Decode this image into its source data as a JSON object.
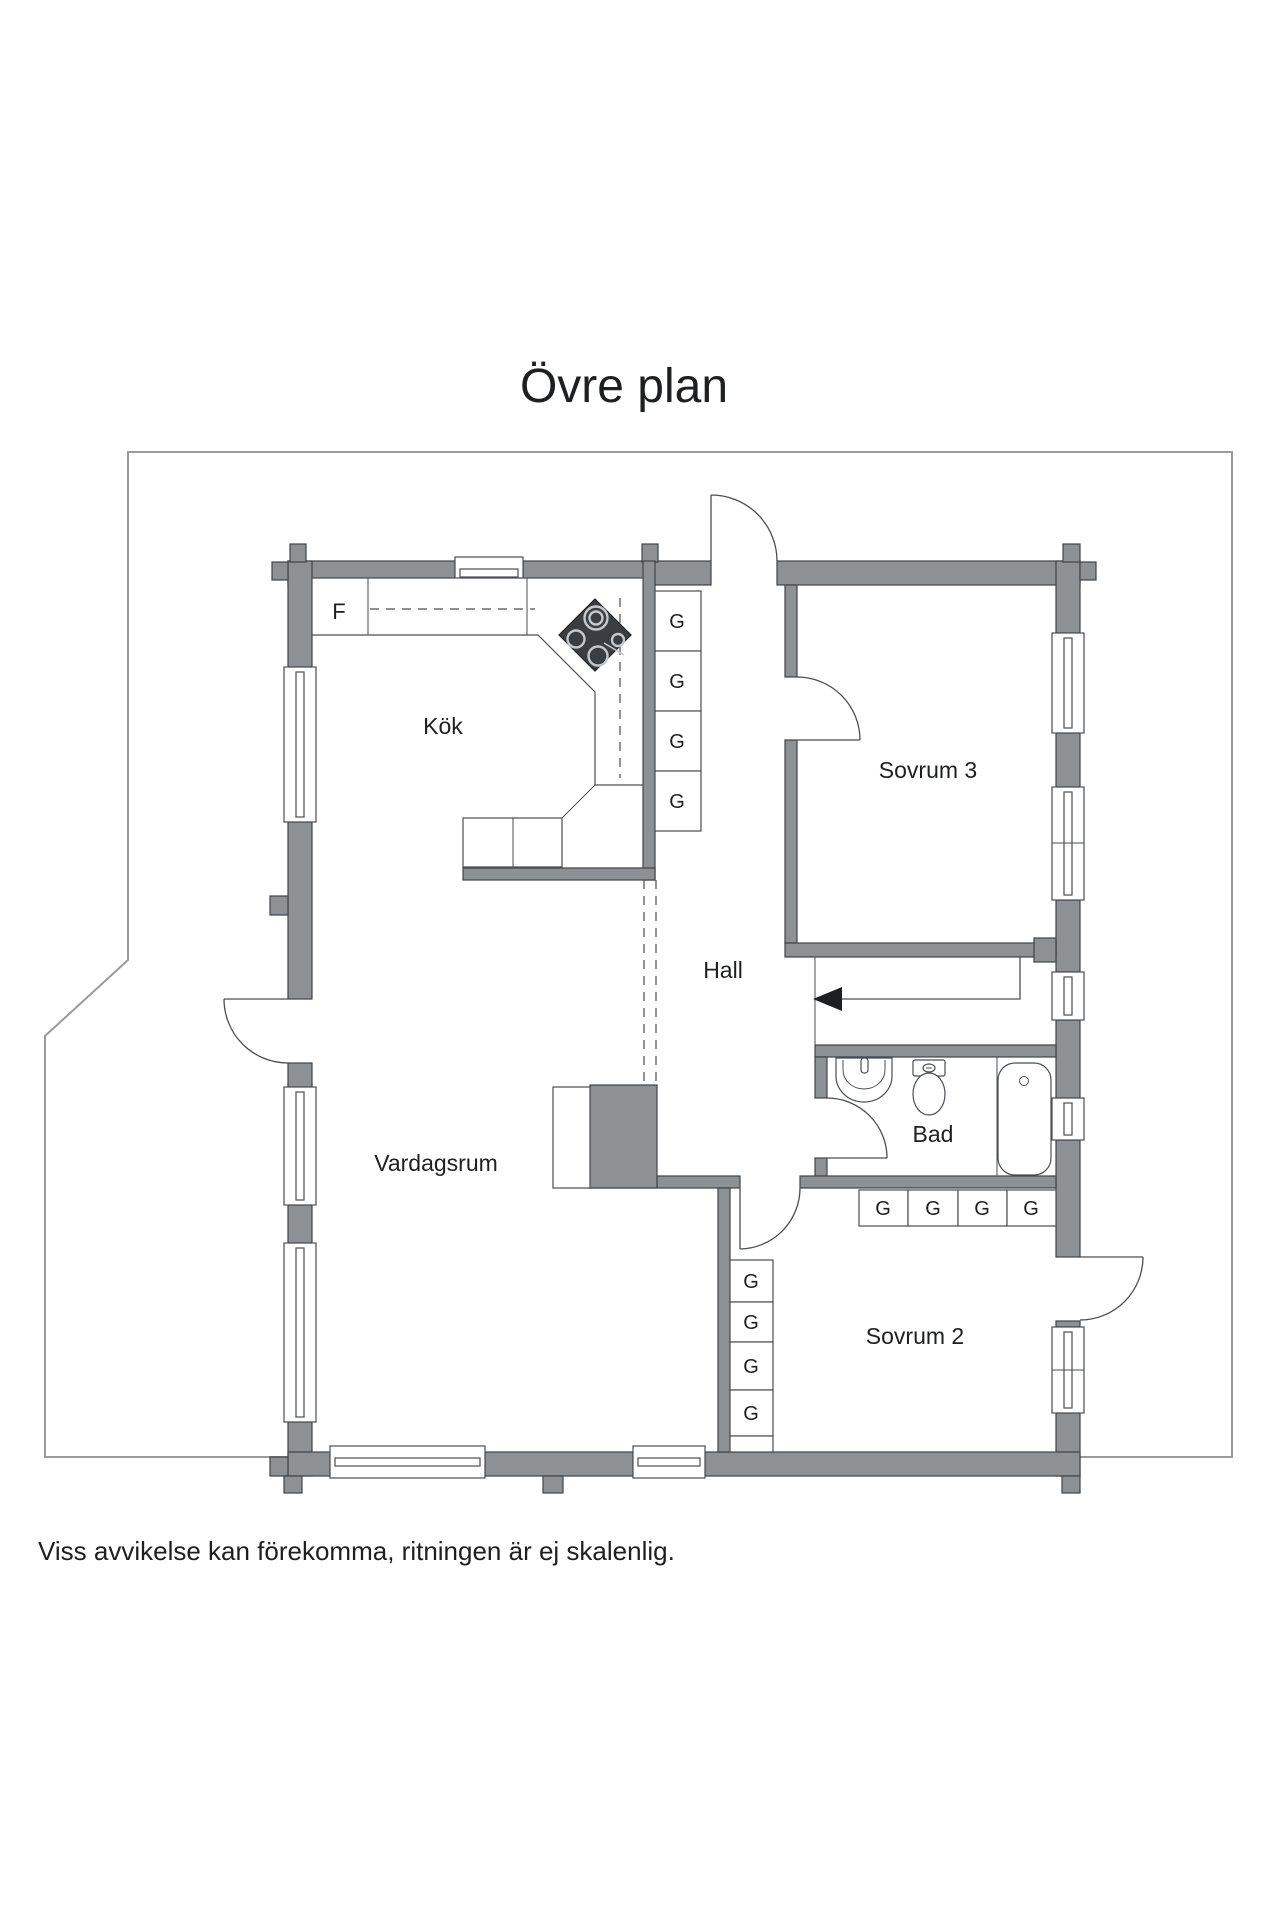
{
  "title": "Övre plan",
  "disclaimer": "Viss avvikelse kan förekomma, ritningen är ej skalenlig.",
  "labels": {
    "kitchen": "Kök",
    "bedroom3": "Sovrum 3",
    "hall": "Hall",
    "living_room": "Vardagsrum",
    "bathroom": "Bad",
    "bedroom2": "Sovrum 2",
    "fridge": "F",
    "wardrobe": "G"
  },
  "colors": {
    "wall": "#8e9194",
    "wall_outline": "#3f4347",
    "line": "#4a4e52",
    "text": "#1e1f20",
    "stove": "#3a3e41",
    "site_outline": "#9b9b9b",
    "background": "#ffffff"
  }
}
